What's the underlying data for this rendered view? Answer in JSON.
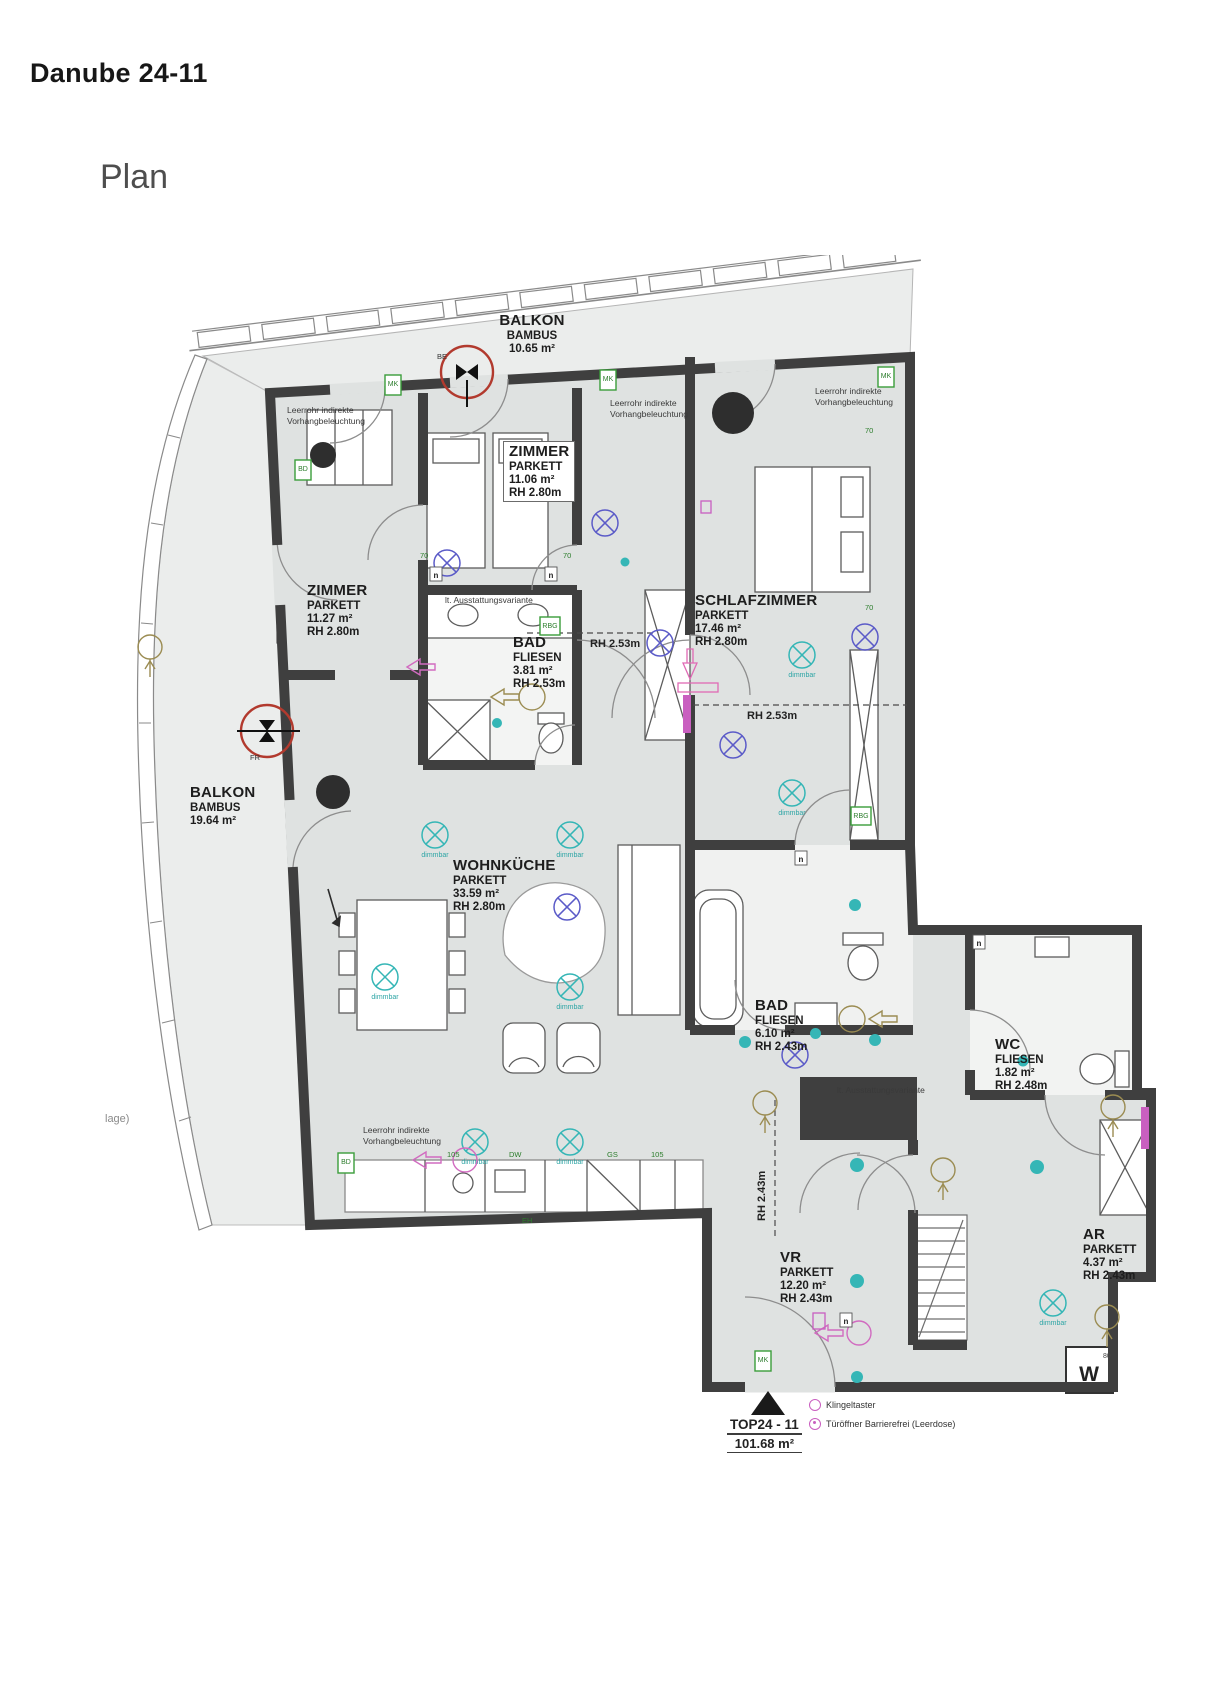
{
  "page": {
    "title": "Danube 24-11",
    "heading": "Plan"
  },
  "plan": {
    "rooms": [
      {
        "id": "balkon-top",
        "name": "BALKON",
        "floor": "BAMBUS",
        "area": "10.65 m²",
        "height": ""
      },
      {
        "id": "zimmer-a",
        "name": "ZIMMER",
        "floor": "PARKETT",
        "area": "11.06 m²",
        "height": "RH 2.80m"
      },
      {
        "id": "zimmer-b",
        "name": "ZIMMER",
        "floor": "PARKETT",
        "area": "11.27 m²",
        "height": "RH 2.80m"
      },
      {
        "id": "schlafzimmer",
        "name": "SCHLAFZIMMER",
        "floor": "PARKETT",
        "area": "17.46 m²",
        "height": "RH 2.80m"
      },
      {
        "id": "bad-klein",
        "name": "BAD",
        "floor": "FLIESEN",
        "area": "3.81 m²",
        "height": "RH 2.53m"
      },
      {
        "id": "balkon-links",
        "name": "BALKON",
        "floor": "BAMBUS",
        "area": "19.64 m²",
        "height": ""
      },
      {
        "id": "wohnkueche",
        "name": "WOHNKÜCHE",
        "floor": "PARKETT",
        "area": "33.59 m²",
        "height": "RH 2.80m"
      },
      {
        "id": "bad-gross",
        "name": "BAD",
        "floor": "FLIESEN",
        "area": "6.10 m²",
        "height": "RH 2.43m"
      },
      {
        "id": "wc",
        "name": "WC",
        "floor": "FLIESEN",
        "area": "1.82 m²",
        "height": "RH 2.48m"
      },
      {
        "id": "abstellraum",
        "name": "AR",
        "floor": "PARKETT",
        "area": "4.37 m²",
        "height": "RH 2.43m"
      },
      {
        "id": "vorraum",
        "name": "VR",
        "floor": "PARKETT",
        "area": "12.20 m²",
        "height": "RH 2.43m"
      }
    ],
    "unit": {
      "label": "TOP24 - 11",
      "area": "101.68 m²"
    },
    "legend": [
      {
        "label": "Klingeltaster"
      },
      {
        "label": "Türöffner Barrierefrei (Leerdose)"
      }
    ],
    "annotations": {
      "leerrohr1": "Leerrohr indirekte",
      "leerrohr2": "Vorhangbeleuchtung",
      "rh253": "RH 2.53m",
      "rh243": "RH 2.43m",
      "dimmbar": "dimmbar",
      "ausstattung": "lt. Ausstattungsvariante",
      "lage": "lage)",
      "fr": "FR",
      "be": "BE",
      "w": "W",
      "w80": "80"
    },
    "tags": {
      "mk": "MK",
      "bd": "BD",
      "rbg": "RBG",
      "eh": "EH",
      "gs": "GS",
      "dw": "DW",
      "s105": "105",
      "s70": "70",
      "n": "n"
    },
    "colors": {
      "wall": "#3f3f3f",
      "floor": "#dfe2e1",
      "balcony": "#ebedec",
      "teal": "#35b6b6",
      "green": "#3a9d3a",
      "magenta": "#c95fc0",
      "blue": "#5b5bc8",
      "red": "#b23a2e",
      "tan": "#9b8c52"
    }
  }
}
